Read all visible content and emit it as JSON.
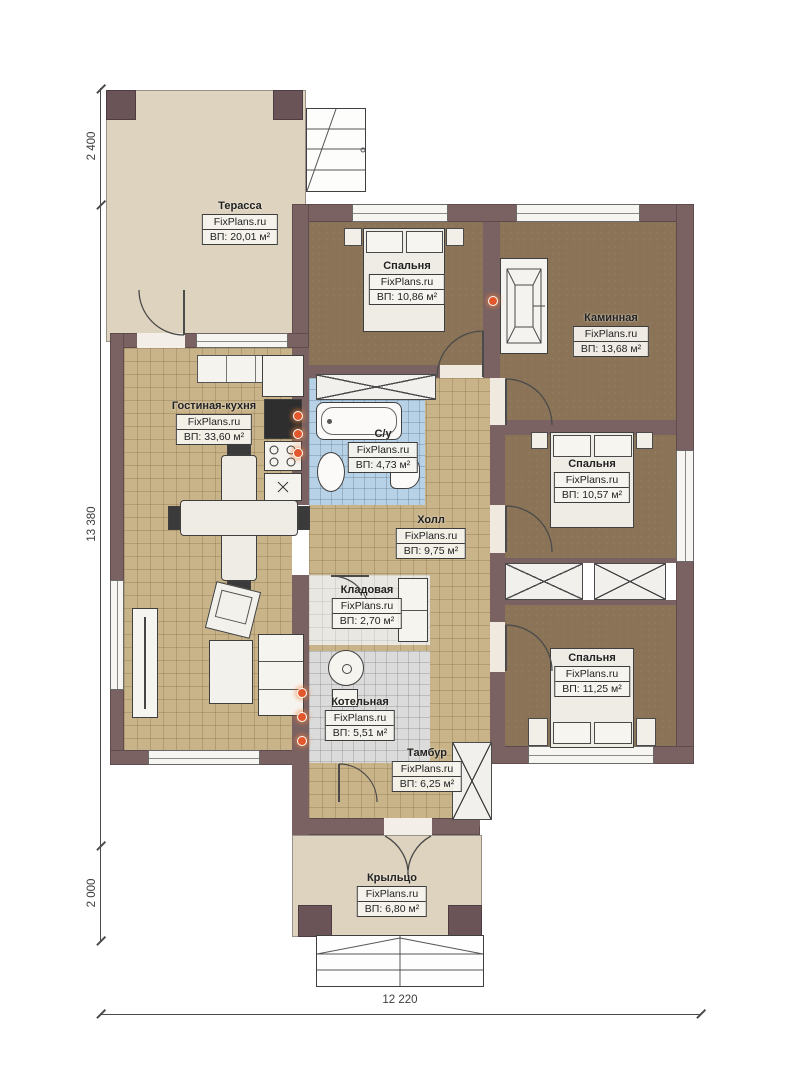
{
  "title": "План одноэтажного дома",
  "branding": "FixPlans.ru",
  "dims": {
    "top_left": "2 400",
    "middle_left": "13 380",
    "bottom_left": "2 000",
    "bottom": "12 220"
  },
  "rooms": [
    {
      "id": "terrace",
      "name": "Терасса",
      "site": "FixPlans.ru",
      "area": "ВП: 20,01 м²"
    },
    {
      "id": "bedroom1",
      "name": "Спальня",
      "site": "FixPlans.ru",
      "area": "ВП: 10,86 м²"
    },
    {
      "id": "fireplace-room",
      "name": "Каминная",
      "site": "FixPlans.ru",
      "area": "ВП: 13,68 м²"
    },
    {
      "id": "living-kitchen",
      "name": "Гостиная-кухня",
      "site": "FixPlans.ru",
      "area": "ВП: 33,60 м²"
    },
    {
      "id": "bathroom",
      "name": "С/у",
      "site": "FixPlans.ru",
      "area": "ВП: 4,73 м²"
    },
    {
      "id": "hall",
      "name": "Холл",
      "site": "FixPlans.ru",
      "area": "ВП: 9,75 м²"
    },
    {
      "id": "bedroom2",
      "name": "Спальня",
      "site": "FixPlans.ru",
      "area": "ВП: 10,57 м²"
    },
    {
      "id": "storage",
      "name": "Кладовая",
      "site": "FixPlans.ru",
      "area": "ВП: 2,70 м²"
    },
    {
      "id": "boiler-room",
      "name": "Котельная",
      "site": "FixPlans.ru",
      "area": "ВП: 5,51 м²"
    },
    {
      "id": "bedroom3",
      "name": "Спальня",
      "site": "FixPlans.ru",
      "area": "ВП: 11,25 м²"
    },
    {
      "id": "vestibule",
      "name": "Тамбур",
      "site": "FixPlans.ru",
      "area": "ВП: 6,25 м²"
    },
    {
      "id": "porch",
      "name": "Крыльцо",
      "site": "FixPlans.ru",
      "area": "ВП: 6,80 м²"
    }
  ],
  "icons": [
    "bed-icon",
    "fireplace-icon",
    "bathtub-icon",
    "sink-icon",
    "toilet-icon",
    "dining-table-icon",
    "sofa-icon",
    "armchair-icon",
    "tv-stand-icon",
    "kitchen-stove-icon",
    "fridge-icon",
    "boiler-icon",
    "wardrobe-icon",
    "door-arc-icon",
    "window-icon",
    "stairs-icon",
    "radiator-dot-icon"
  ],
  "colors": {
    "wall": "#7a6263",
    "floor_brown": "#8a7356",
    "floor_tan": "#c9b388",
    "floor_beige": "#ded3bf",
    "tile_blue": "#b7d2e6",
    "tile_grey": "#dbdbdb",
    "accent_orange": "#e2572b"
  }
}
